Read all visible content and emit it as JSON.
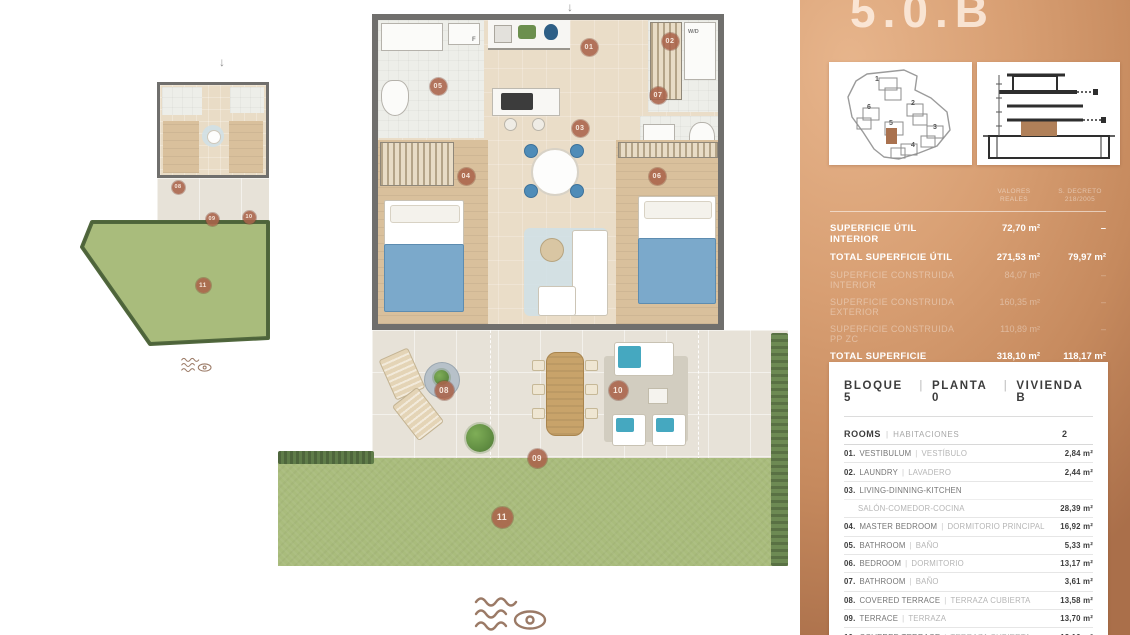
{
  "colors": {
    "copper": "#C98A5E",
    "badge": "#AA634A",
    "grass": "#A9BC7C",
    "wall": "#706F6D",
    "wood": "#D9C09C",
    "accent_blue": "#7BA9CB"
  },
  "plan": {
    "arrow_char": "↓",
    "arrows": [
      {
        "x": 567,
        "y": 0
      },
      {
        "x": 219,
        "y": 55
      }
    ],
    "labels": [
      {
        "text": "W/D",
        "x": 688,
        "y": 29,
        "fs": 5.5
      },
      {
        "text": "F",
        "x": 472,
        "y": 37,
        "fs": 6
      }
    ],
    "badges": [
      {
        "n": "01",
        "x": 589,
        "y": 47,
        "s": 17
      },
      {
        "n": "02",
        "x": 670,
        "y": 41,
        "s": 17
      },
      {
        "n": "03",
        "x": 580,
        "y": 128,
        "s": 17
      },
      {
        "n": "04",
        "x": 466,
        "y": 176,
        "s": 17
      },
      {
        "n": "05",
        "x": 438,
        "y": 86,
        "s": 17
      },
      {
        "n": "06",
        "x": 657,
        "y": 176,
        "s": 17
      },
      {
        "n": "07",
        "x": 658,
        "y": 95,
        "s": 17
      },
      {
        "n": "08",
        "x": 444,
        "y": 390,
        "s": 19
      },
      {
        "n": "09",
        "x": 537,
        "y": 458,
        "s": 19
      },
      {
        "n": "10",
        "x": 618,
        "y": 390,
        "s": 19
      },
      {
        "n": "11",
        "x": 502,
        "y": 517,
        "s": 21
      },
      {
        "n": "08",
        "x": 178,
        "y": 187,
        "s": 13
      },
      {
        "n": "09",
        "x": 212,
        "y": 219,
        "s": 13
      },
      {
        "n": "10",
        "x": 249,
        "y": 217,
        "s": 13
      },
      {
        "n": "11",
        "x": 203,
        "y": 285,
        "s": 15
      }
    ]
  },
  "panel": {
    "title": "5.0.B",
    "sep": "|",
    "site_map": {
      "blocks": [
        {
          "n": "1",
          "x": 46,
          "y": 14
        },
        {
          "n": "2",
          "x": 82,
          "y": 38
        },
        {
          "n": "3",
          "x": 104,
          "y": 62
        },
        {
          "n": "4",
          "x": 82,
          "y": 80
        },
        {
          "n": "5",
          "x": 60,
          "y": 58
        },
        {
          "n": "6",
          "x": 38,
          "y": 42
        }
      ]
    },
    "surface_table": {
      "col_header_1": "VALORES REALES",
      "col_header_2": "S. DECRETO 218/2005",
      "rows": [
        {
          "label": "SUPERFICIE ÚTIL INTERIOR",
          "v1": "72,70 m²",
          "v2": "–",
          "strong": true
        },
        {
          "label": "TOTAL SUPERFICIE ÚTIL",
          "v1": "271,53 m²",
          "v2": "79,97 m²",
          "strong": true
        },
        {
          "label": "SUPERFICIE CONSTRUIDA INTERIOR",
          "v1": "84,07 m²",
          "v2": "–",
          "strong": false
        },
        {
          "label": "SUPERFICIE CONSTRUIDA EXTERIOR",
          "v1": "160,35 m²",
          "v2": "–",
          "strong": false
        },
        {
          "label": "SUPERFICIE CONSTRUIDA PP ZC",
          "v1": "110,89 m²",
          "v2": "–",
          "strong": false
        },
        {
          "label": "TOTAL SUPERFICIE CONSTRUIDA",
          "v1": "318,10 m²",
          "v2": "118,17 m²",
          "strong": true
        }
      ]
    },
    "unit_card": {
      "header": [
        "BLOQUE 5",
        "PLANTA 0",
        "VIVIENDA B"
      ],
      "rooms_head": {
        "en": "ROOMS",
        "es": "HABITACIONES",
        "count": "2"
      },
      "rooms": [
        {
          "num": "01.",
          "en": "VESTIBULUM",
          "es": "VESTÍBULO",
          "area": "2,84 m²",
          "two": false
        },
        {
          "num": "02.",
          "en": "LAUNDRY",
          "es": "LAVADERO",
          "area": "2,44 m²",
          "two": false
        },
        {
          "num": "03.",
          "en": "LIVING-DINNING-KITCHEN",
          "es": "SALÓN-COMEDOR-COCINA",
          "area": "28,39 m²",
          "two": true
        },
        {
          "num": "04.",
          "en": "MASTER BEDROOM",
          "es": "DORMITORIO PRINCIPAL",
          "area": "16,92 m²",
          "two": false
        },
        {
          "num": "05.",
          "en": "BATHROOM",
          "es": "BAÑO",
          "area": "5,33 m²",
          "two": false
        },
        {
          "num": "06.",
          "en": "BEDROOM",
          "es": "DORMITORIO",
          "area": "13,17 m²",
          "two": false
        },
        {
          "num": "07.",
          "en": "BATHROOM",
          "es": "BAÑO",
          "area": "3,61 m²",
          "two": false
        },
        {
          "num": "08.",
          "en": "COVERED TERRACE",
          "es": "TERRAZA CUBIERTA",
          "area": "13,58 m²",
          "two": false
        },
        {
          "num": "09.",
          "en": "TERRACE",
          "es": "TERRAZA",
          "area": "13,70 m²",
          "two": false
        },
        {
          "num": "10.",
          "en": "COVERED TERRACE",
          "es": "TERRAZA CUBIERTA",
          "area": "13,16 m²",
          "two": false
        },
        {
          "num": "11.",
          "en": "GARDEN",
          "es": "JARDÍN",
          "area": "158,39 m²",
          "two": false
        }
      ]
    }
  }
}
